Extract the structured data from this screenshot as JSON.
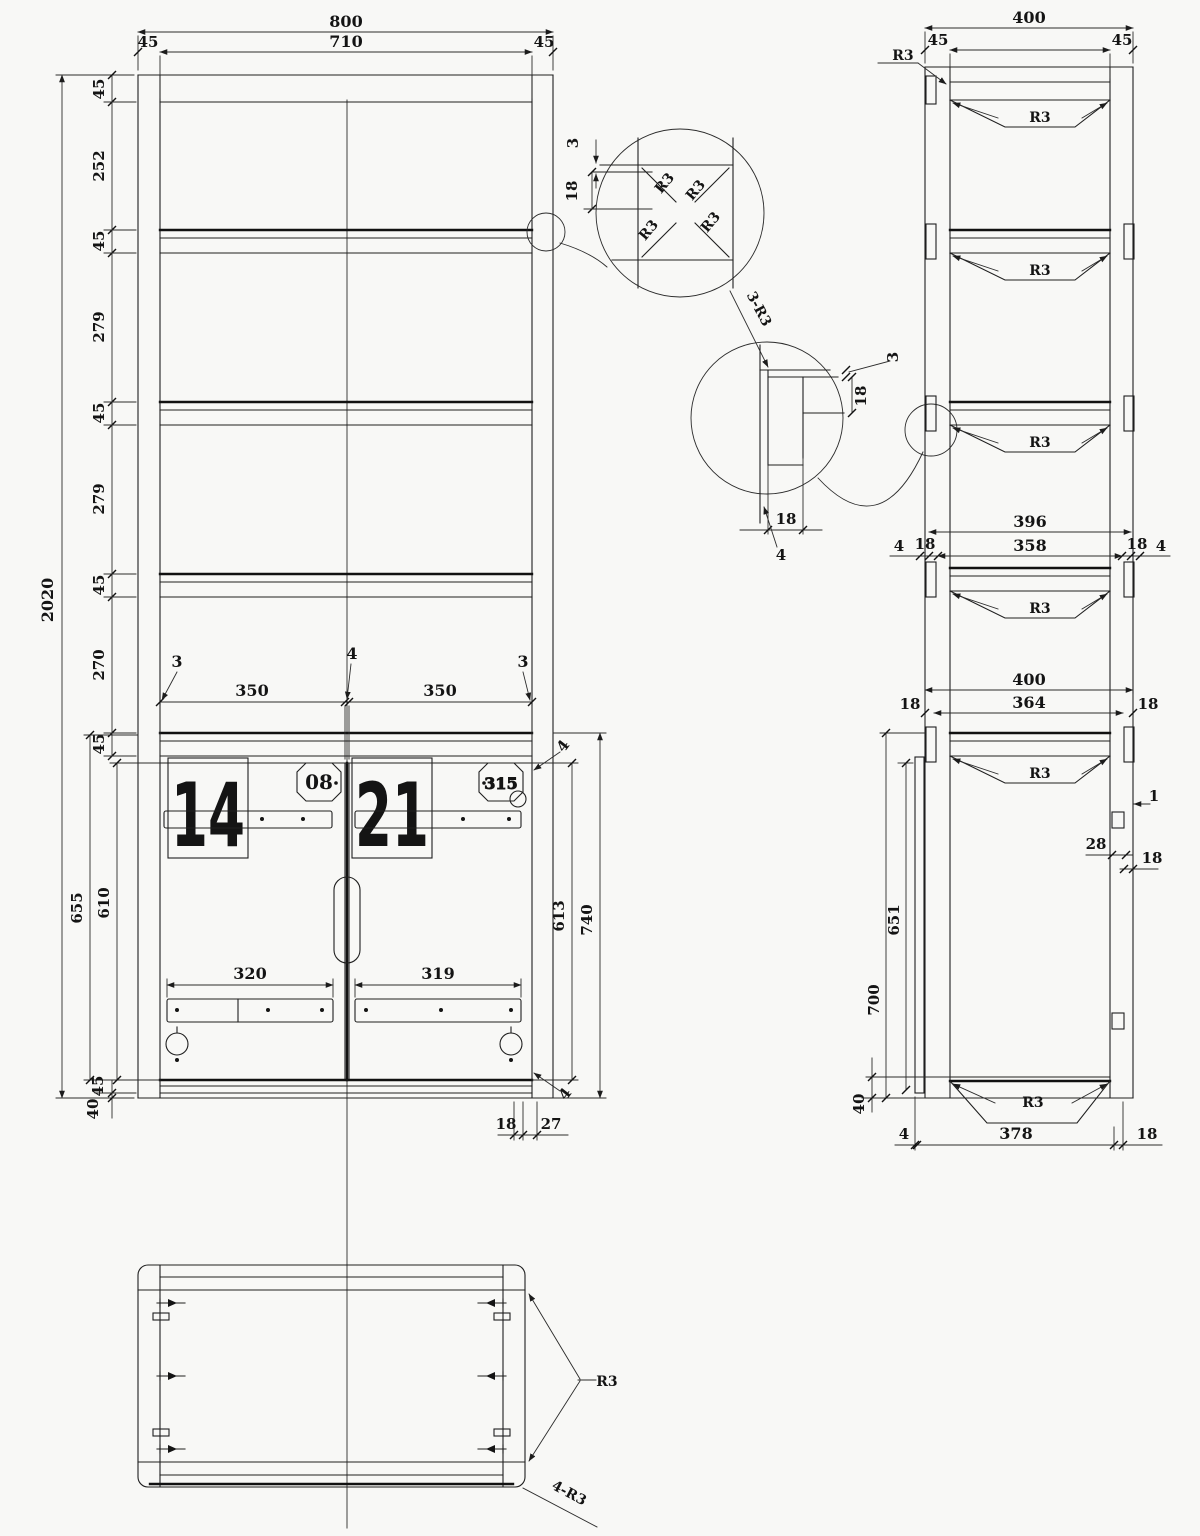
{
  "front": {
    "w800": "800",
    "w710": "710",
    "w45l": "45",
    "w45r": "45",
    "h2020": "2020",
    "chain": [
      "45",
      "252",
      "45",
      "279",
      "45",
      "279",
      "45",
      "270",
      "45"
    ],
    "g3l": "3",
    "d350l": "350",
    "g4": "4",
    "d350r": "350",
    "g3r": "3",
    "n14": "14",
    "n21": "21",
    "b08": "08",
    "b315": "315",
    "p320": "320",
    "p319": "319",
    "d655": "655",
    "d610": "610",
    "d45b": "45",
    "d40b": "40",
    "d613": "613",
    "d740": "740",
    "g4t": "4",
    "g4b": "4",
    "d18": "18",
    "d27": "27"
  },
  "detail1": {
    "d3": "3",
    "d18": "18",
    "r": [
      "R3",
      "R3",
      "R3",
      "R3"
    ],
    "callout": "3-R3"
  },
  "detail2": {
    "d3": "3",
    "d18s": "18",
    "d18b": "18",
    "d4": "4"
  },
  "side": {
    "w400": "400",
    "w310": "310",
    "w45l": "45",
    "w45r": "45",
    "r3": "R3",
    "shelves": [
      "R3",
      "R3",
      "R3",
      "R3",
      "R3",
      "R3"
    ],
    "d396": "396",
    "d358": "358",
    "g4l": "4",
    "g18l": "18",
    "g18r": "18",
    "g4r": "4",
    "w400b": "400",
    "w364": "364",
    "g18l2": "18",
    "g18r2": "18",
    "d651": "651",
    "d700": "700",
    "d40": "40",
    "c1": "1",
    "c28": "28",
    "c18": "18",
    "b4": "4",
    "b378": "378",
    "b18": "18"
  },
  "plan": {
    "r3": "R3",
    "r4r3": "4-R3"
  }
}
